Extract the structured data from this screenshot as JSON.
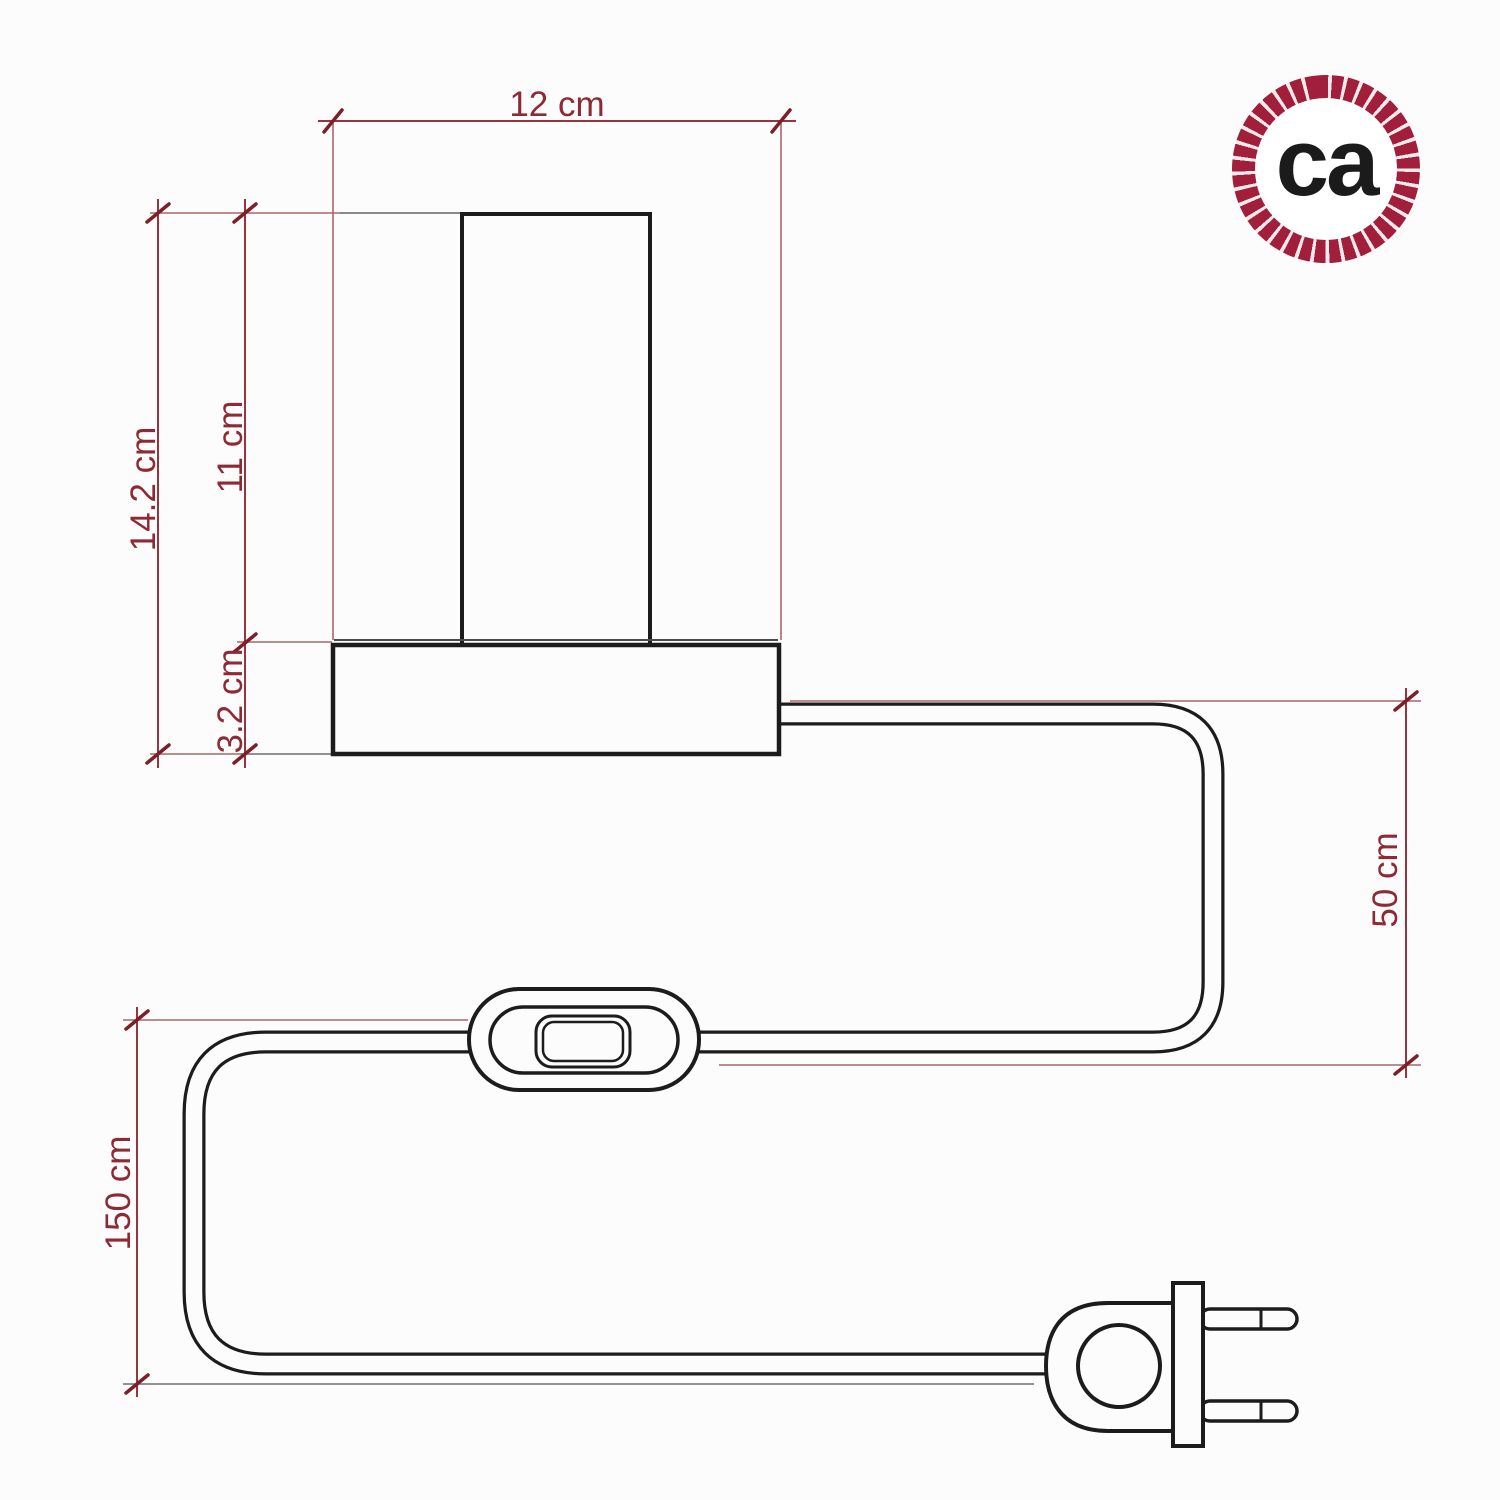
{
  "diagram": {
    "dimensions": {
      "base_width": "12 cm",
      "total_height": "14.2 cm",
      "shade_height": "11 cm",
      "base_height": "3.2 cm",
      "cable_drop": "50 cm",
      "cable_length": "150 cm"
    }
  },
  "logo": {
    "text": "ca"
  },
  "colors": {
    "background": "#fcfcfc",
    "drawing_line": "#1c1c1c",
    "dimension_text": "#8d2a33",
    "dimension_line": "#96353d",
    "tick_mark": "#7d1f29",
    "extension_line_red": "#a8666b",
    "extension_line_gray": "#6f6f6f",
    "logo_ring": "#a21f3c",
    "logo_text": "#1b1b1b"
  }
}
